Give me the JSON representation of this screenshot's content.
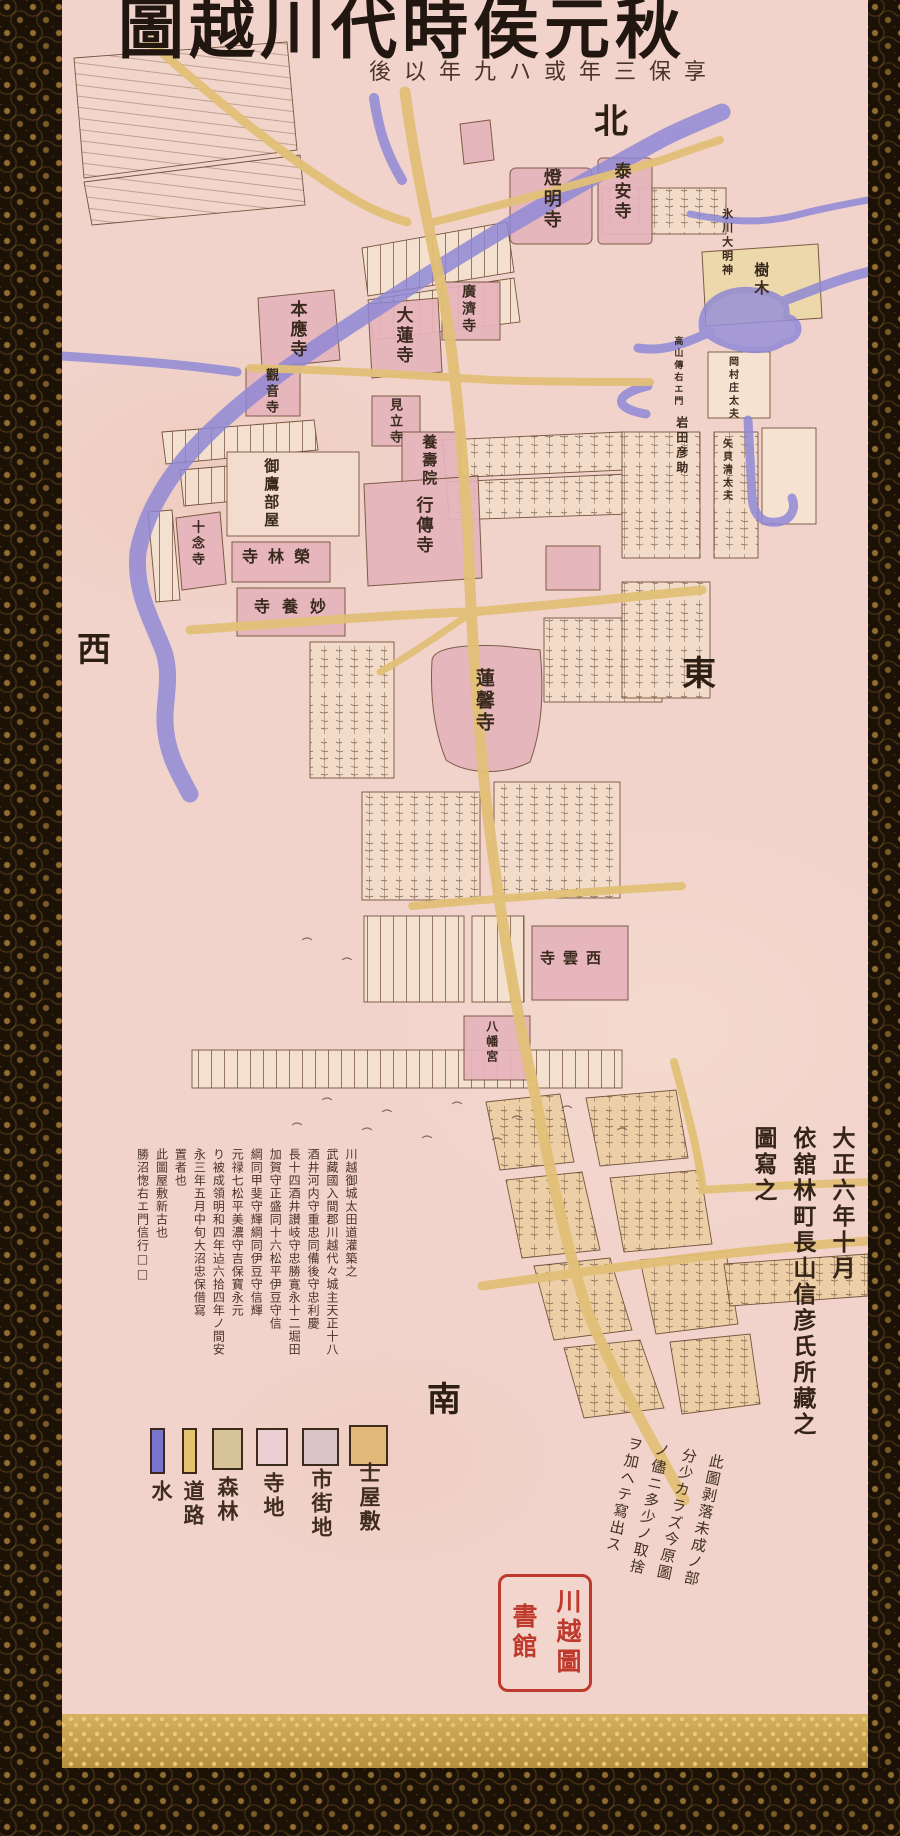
{
  "scroll": {
    "title": "秋元侯時代川越圖",
    "subtitle": "享保三年或ハ九年以後"
  },
  "directions": {
    "north": "北",
    "west": "西",
    "east": "東",
    "south": "南"
  },
  "map": {
    "labels": [
      {
        "text": "燈明寺"
      },
      {
        "text": "泰安寺"
      },
      {
        "text": "本應寺"
      },
      {
        "text": "大蓮寺"
      },
      {
        "text": "廣濟寺"
      },
      {
        "text": "觀音寺"
      },
      {
        "text": "見立寺"
      },
      {
        "text": "養壽院"
      },
      {
        "text": "行傳寺"
      },
      {
        "text": "御鷹部屋"
      },
      {
        "text": "十念寺"
      },
      {
        "text": "榮林寺"
      },
      {
        "text": "妙養寺"
      },
      {
        "text": "蓮馨寺"
      },
      {
        "text": "西雲寺"
      },
      {
        "text": "八幡宮"
      },
      {
        "text": "氷川大明神"
      },
      {
        "text": "樹木"
      },
      {
        "text": "岡村庄太夫"
      },
      {
        "text": "高山傳右エ門"
      },
      {
        "text": "岩田彦助"
      },
      {
        "text": "矢貝清太夫"
      }
    ],
    "colors": {
      "river": "#8e87d6",
      "road": "#e2c077",
      "temple": "#e6b4bc",
      "paper": "#f1d3cb",
      "ink": "#33231a",
      "seal_red": "#bf3a2c"
    }
  },
  "legend": {
    "items": [
      {
        "label": "水",
        "color": "#7b74cf",
        "shape": "bar"
      },
      {
        "label": "道路",
        "color": "#e3c36d",
        "shape": "bar"
      },
      {
        "label": "森林",
        "color": "#d8c49a",
        "shape": "square"
      },
      {
        "label": "寺地",
        "color": "#eccfd2",
        "shape": "square"
      },
      {
        "label": "市街地",
        "color": "#d9c3c6",
        "shape": "square"
      },
      {
        "label": "士屋敷",
        "color": "#e3b778",
        "shape": "square"
      }
    ]
  },
  "colophon": {
    "columns": [
      "川越御城太田道灌築之",
      "武藏國入間郡川越代々城主天正十八",
      "酒井河内守重忠同備後守忠利慶",
      "長十四酒井讃岐守忠勝寛永十二堀田",
      "加賀守正盛同十六松平伊豆守信",
      "綱同甲斐守輝綱同伊豆守信輝",
      "元禄七松平美濃守吉保寶永元",
      "り被成領明和四年迠六拾四年ノ間安",
      "永三年五月中旬大沼忠保借寫",
      "置者也",
      "此圖屋敷新古也",
      "勝沼愡右エ門信行□□"
    ]
  },
  "note": {
    "columns": [
      "此圖剥落未成ノ部",
      "分少カラズ今原圖",
      "ノ儘ニ多少ノ取捨",
      "ヲ加ヘテ寫出ス"
    ]
  },
  "attribution": {
    "columns": [
      "大正六年十月",
      "依舘林町長山信彦氏所藏之",
      "圖寫之"
    ]
  },
  "seal": {
    "col_right": "川越圖",
    "col_left": "書館"
  }
}
